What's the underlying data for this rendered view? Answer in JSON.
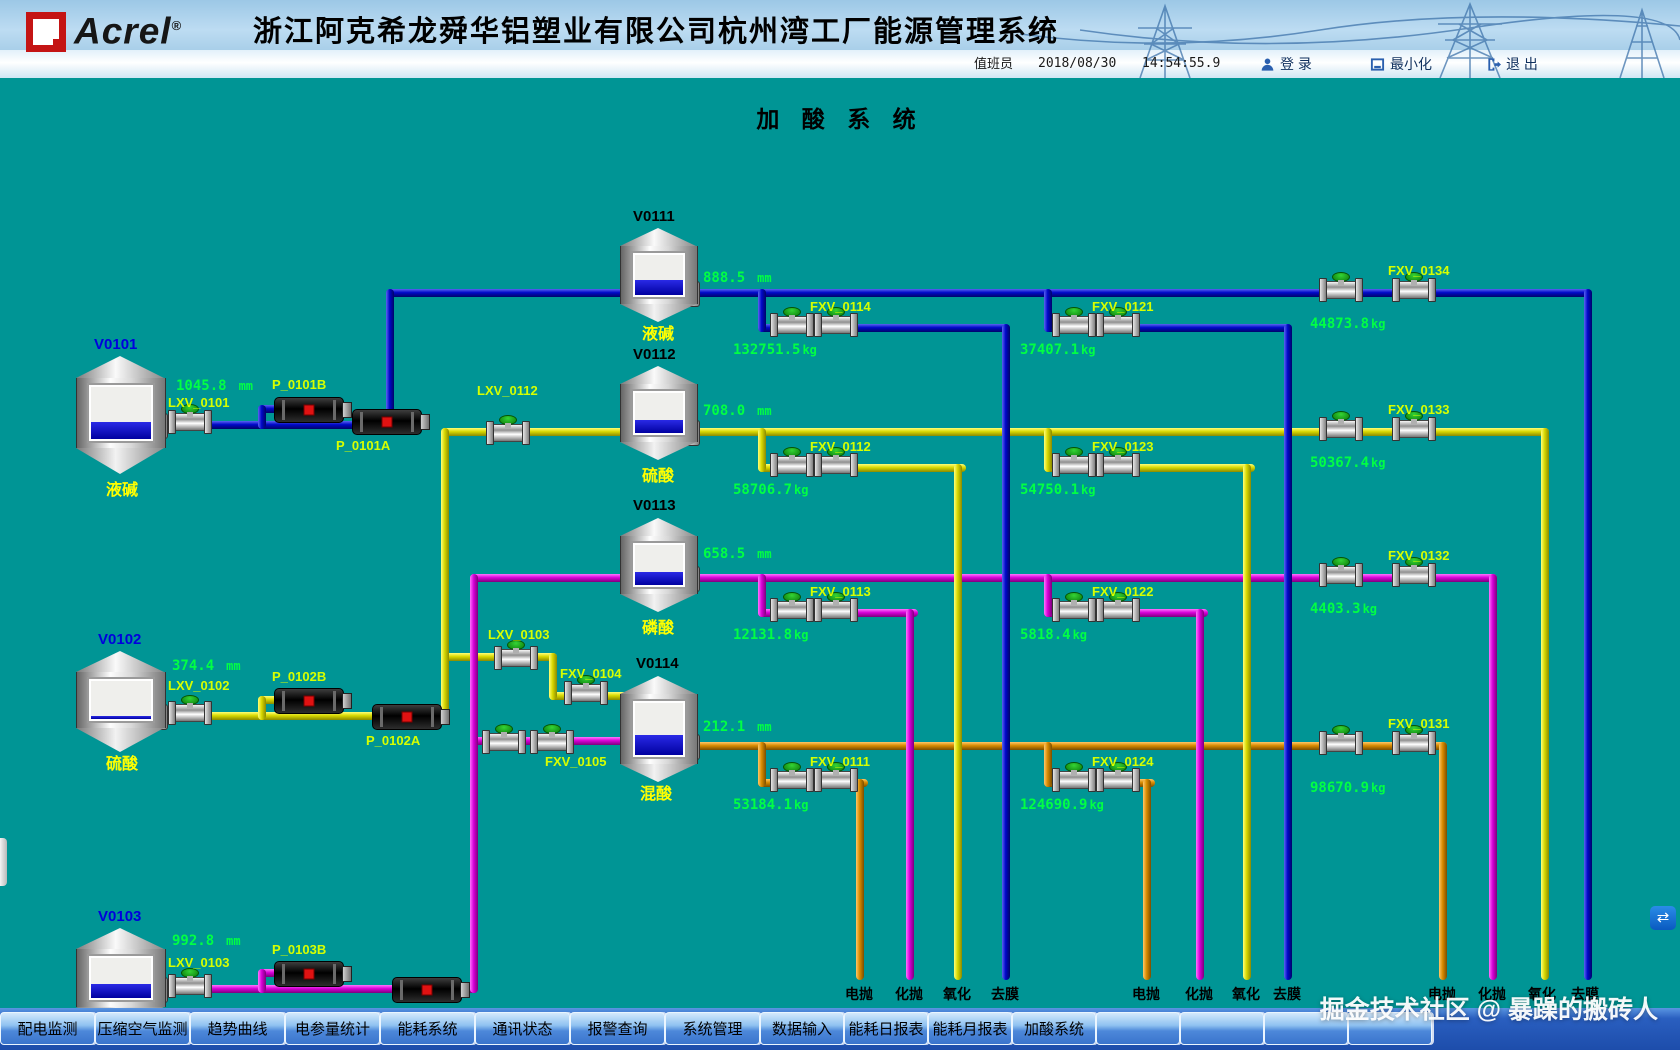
{
  "header": {
    "brand": "Acrel",
    "reg": "®",
    "title": "浙江阿克希龙舜华铝塑业有限公司杭州湾工厂能源管理系统",
    "operator_label": "值班员",
    "date": "2018/08/30",
    "time": "14:54:55.9",
    "login": "登 录",
    "minimize": "最小化",
    "logout": "退 出"
  },
  "diagram": {
    "title": "加 酸 系 统"
  },
  "colors": {
    "background_teal": "#009595",
    "pipe_alkali_blue": "#0008c8",
    "pipe_sulfuric_yellow": "#d8d800",
    "pipe_phosphoric_magenta": "#d800d8",
    "pipe_mixed_orange": "#d88a00",
    "value_green": "#00ff44",
    "label_yellow": "#ffff00",
    "equip_label": "#d6ff00"
  },
  "tanks": [
    {
      "id": "V0101",
      "chem": "液碱",
      "level": "1045.8",
      "unit": "mm",
      "fill": "height:30%"
    },
    {
      "id": "V0102",
      "chem": "硫酸",
      "level": "374.4",
      "unit": "mm",
      "fill": "height:6%"
    },
    {
      "id": "V0103",
      "chem": "磷酸",
      "level": "992.8",
      "unit": "mm",
      "fill": "height:32%"
    },
    {
      "id": "V0111",
      "chem": "液碱",
      "level": "888.5",
      "unit": "mm",
      "fill": "height:34%"
    },
    {
      "id": "V0112",
      "chem": "硫酸",
      "level": "708.0",
      "unit": "mm",
      "fill": "height:30%"
    },
    {
      "id": "V0113",
      "chem": "磷酸",
      "level": "658.5",
      "unit": "mm",
      "fill": "height:30%"
    },
    {
      "id": "V0114",
      "chem": "混酸",
      "level": "212.1",
      "unit": "mm",
      "fill": "height:36%"
    }
  ],
  "equipment": {
    "lxv0101": "LXV_0101",
    "lxv0102": "LXV_0102",
    "lxv0103": "LXV_0103",
    "lxv0112": "LXV_0112",
    "lxv0103b": "LXV_0103",
    "fxv0104": "FXV_0104",
    "fxv0105": "FXV_0105",
    "p0101a": "P_0101A",
    "p0101b": "P_0101B",
    "p0102a": "P_0102A",
    "p0102b": "P_0102B",
    "p0103a": "P_0103A",
    "p0103b": "P_0103B"
  },
  "flows": [
    {
      "tag": "FXV_0114",
      "value": "132751.5",
      "unit": "kg"
    },
    {
      "tag": "FXV_0121",
      "value": "37407.1",
      "unit": "kg"
    },
    {
      "tag": "FXV_0134",
      "value": "44873.8",
      "unit": "kg"
    },
    {
      "tag": "FXV_0112",
      "value": "58706.7",
      "unit": "kg"
    },
    {
      "tag": "FXV_0123",
      "value": "54750.1",
      "unit": "kg"
    },
    {
      "tag": "FXV_0133",
      "value": "50367.4",
      "unit": "kg"
    },
    {
      "tag": "FXV_0113",
      "value": "12131.8",
      "unit": "kg"
    },
    {
      "tag": "FXV_0122",
      "value": "5818.4",
      "unit": "kg"
    },
    {
      "tag": "FXV_0132",
      "value": "4403.3",
      "unit": "kg"
    },
    {
      "tag": "FXV_0111",
      "value": "53184.1",
      "unit": "kg"
    },
    {
      "tag": "FXV_0124",
      "value": "124690.9",
      "unit": "kg"
    },
    {
      "tag": "FXV_0131",
      "value": "98670.9",
      "unit": "kg"
    }
  ],
  "lines": [
    {
      "name": "一号线",
      "outlets": [
        "电抛",
        "化抛",
        "氧化",
        "去膜"
      ]
    },
    {
      "name": "二号线",
      "outlets": [
        "电抛",
        "化抛",
        "氧化",
        "去膜"
      ]
    },
    {
      "name": "三号线",
      "outlets": [
        "电抛",
        "化抛",
        "氧化",
        "去膜"
      ]
    }
  ],
  "nav": {
    "buttons": [
      "配电监测",
      "压缩空气监测",
      "趋势曲线",
      "电参量统计",
      "能耗系统",
      "通讯状态",
      "报警查询",
      "系统管理",
      "数据输入",
      "能耗日报表",
      "能耗月报表",
      "加酸系统"
    ]
  },
  "watermark": "掘金技术社区 @ 暴躁的搬砖人"
}
